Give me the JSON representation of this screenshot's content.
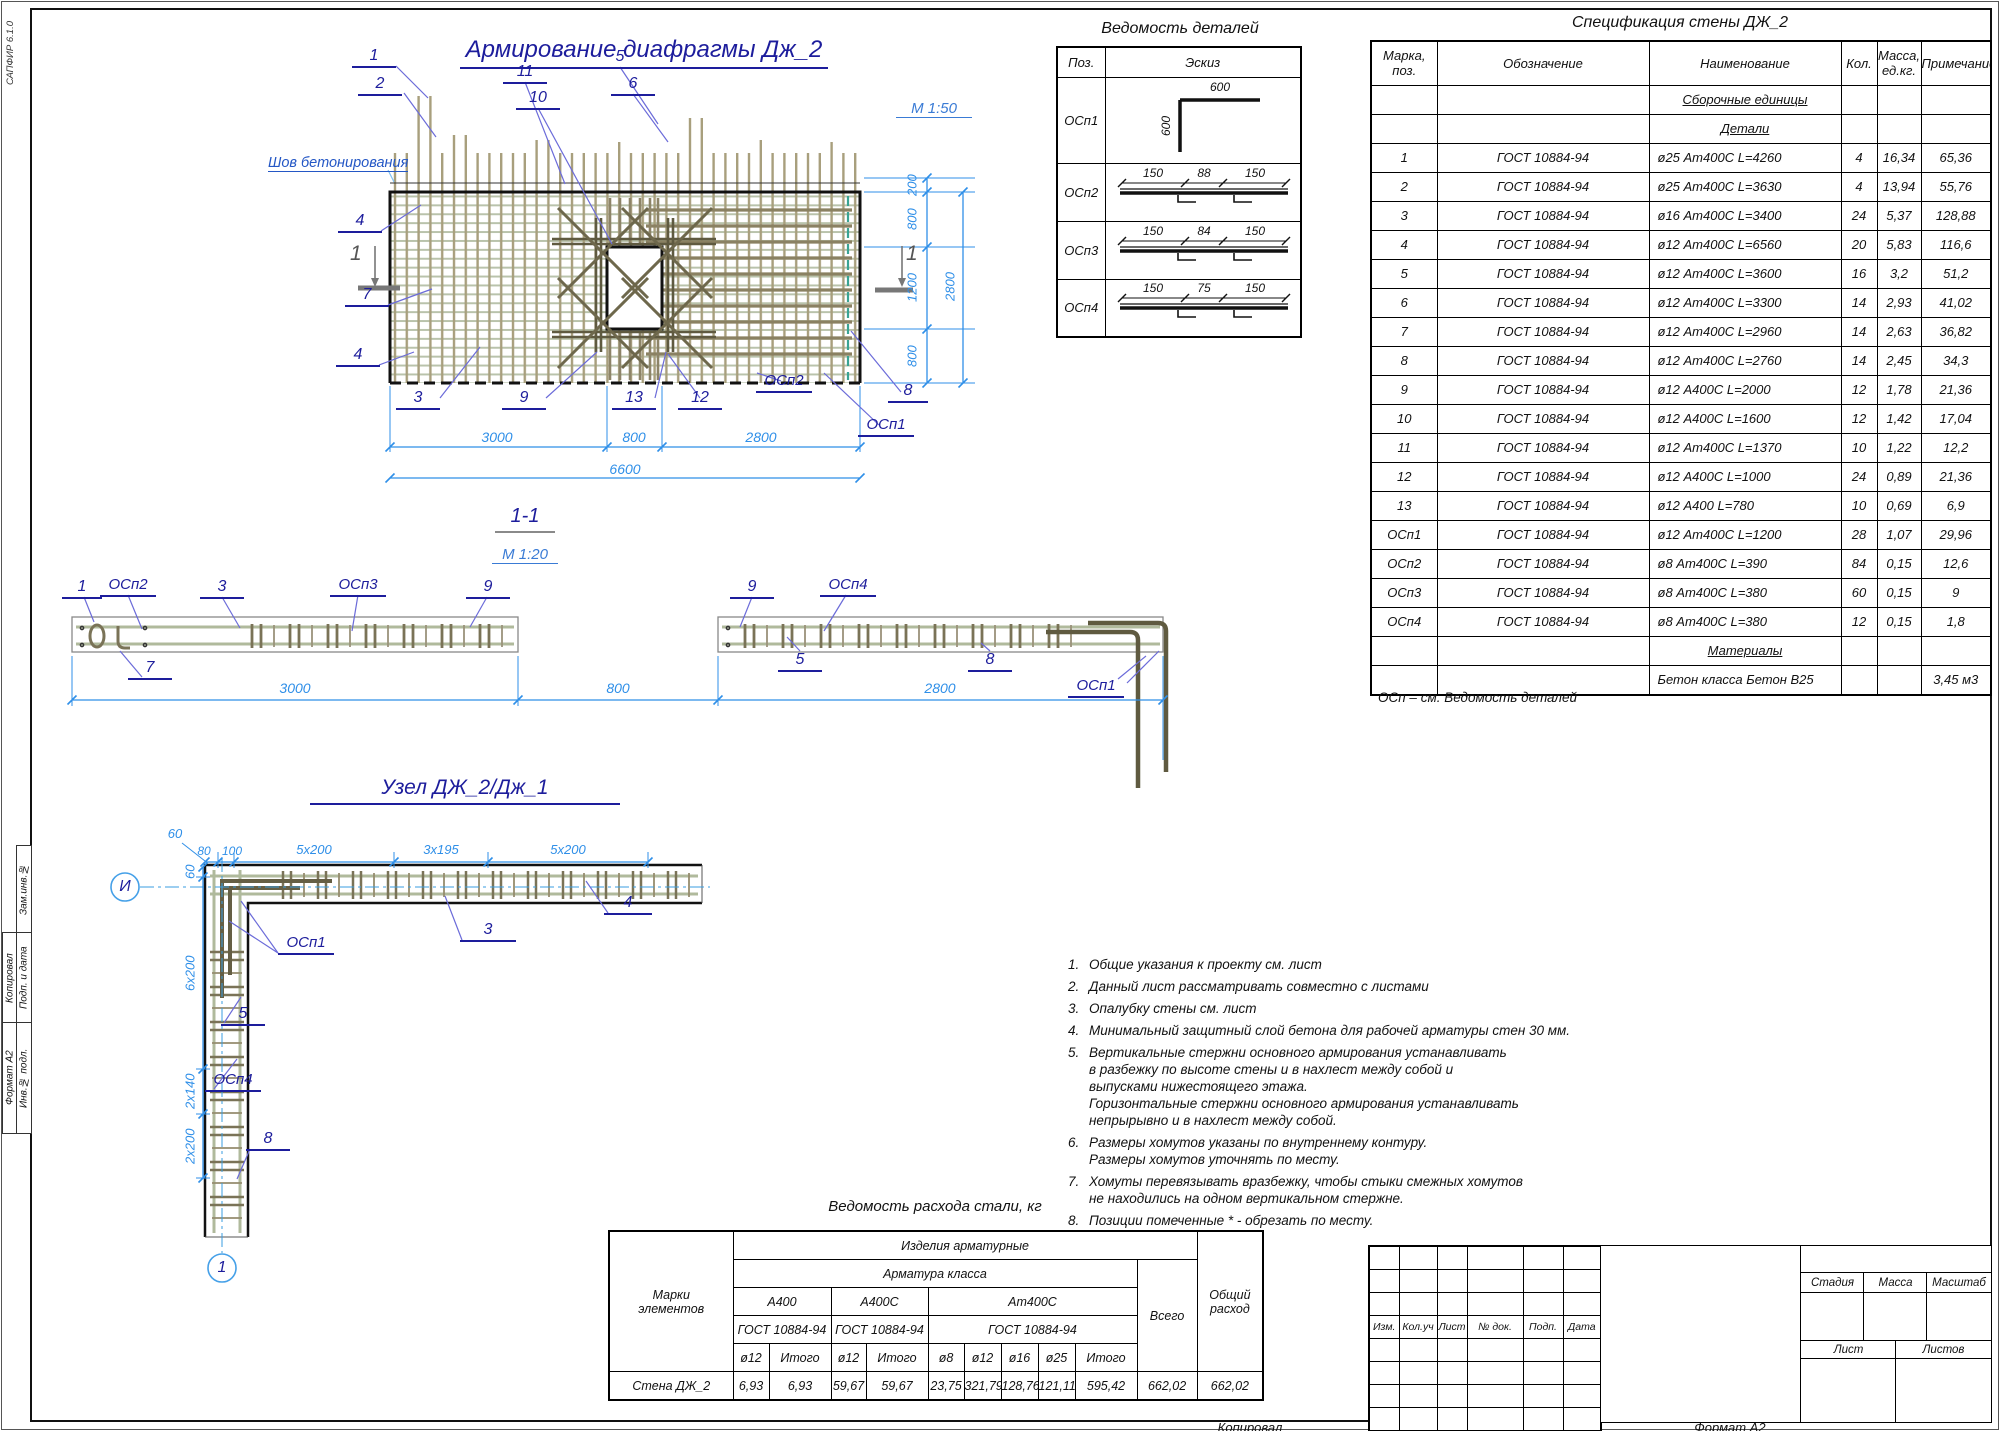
{
  "sheet": {
    "sapfir": "САПФИР 6.1.0",
    "margin_outer": [
      "Копировал",
      "Формат А2"
    ],
    "margin_inner": [
      "Зам.инв.№",
      "Подп. и дата",
      "Инв.№ подл."
    ],
    "footer": {
      "kopiroval": "Копировал",
      "format": "Формат А2"
    }
  },
  "main": {
    "title": "Армирование диафрагмы Дж_2",
    "scale": "М 1:50",
    "seam": "Шов бетонирования",
    "section_digit": "1",
    "callouts": [
      "1",
      "2",
      "11",
      "10",
      "5",
      "6",
      "4",
      "7",
      "4",
      "3",
      "9",
      "13",
      "12",
      "ОСп2",
      "8",
      "ОСп1"
    ],
    "dims_bottom": [
      "3000",
      "800",
      "2800",
      "6600"
    ],
    "dims_right": [
      "200",
      "800",
      "1200",
      "800",
      "2800"
    ]
  },
  "section": {
    "title": "1-1",
    "scale": "М 1:20",
    "callouts": [
      "1",
      "ОСп2",
      "3",
      "ОСп3",
      "9",
      "7",
      "9",
      "ОСп4",
      "5",
      "8",
      "ОСп1"
    ],
    "dims": [
      "3000",
      "800",
      "2800"
    ]
  },
  "node": {
    "title": "Узел  ДЖ_2/Дж_1",
    "axis": "И",
    "bubble": "1",
    "callouts": [
      "ОСп1",
      "3",
      "4",
      "5",
      "ОСп4",
      "8"
    ],
    "dims_top": [
      "60",
      "80",
      "100",
      "5x200",
      "3x195",
      "5x200"
    ],
    "dims_left": [
      "60",
      "6x200",
      "2x140",
      "2x200"
    ]
  },
  "details": {
    "title": "Ведомость деталей",
    "h_poz": "Поз.",
    "h_eskiz": "Эскиз",
    "rows": [
      "ОСп1",
      "ОСп2",
      "ОСп3",
      "ОСп4"
    ],
    "s1": [
      "600",
      "600"
    ],
    "s2": [
      "150",
      "88",
      "150"
    ],
    "s3": [
      "150",
      "84",
      "150"
    ],
    "s4": [
      "150",
      "75",
      "150"
    ]
  },
  "spec": {
    "title": "Спецификация стены ДЖ_2",
    "h_marka": [
      "Марка,",
      "поз."
    ],
    "h_oboz": "Обозначение",
    "h_name": "Наименование",
    "h_qty": "Кол.",
    "h_mass": [
      "Масса,",
      "ед.кг."
    ],
    "h_note": "Примечание",
    "group_sborka": "Сборочные единицы",
    "group_detali": "Детали",
    "group_materialy": "Материалы",
    "rows": [
      [
        "1",
        "ГОСТ 10884-94",
        "ø25 Ат400С L=4260",
        "4",
        "16,34",
        "65,36"
      ],
      [
        "2",
        "ГОСТ 10884-94",
        "ø25 Ат400С L=3630",
        "4",
        "13,94",
        "55,76"
      ],
      [
        "3",
        "ГОСТ 10884-94",
        "ø16 Ат400С L=3400",
        "24",
        "5,37",
        "128,88"
      ],
      [
        "4",
        "ГОСТ 10884-94",
        "ø12 Ат400С L=6560",
        "20",
        "5,83",
        "116,6"
      ],
      [
        "5",
        "ГОСТ 10884-94",
        "ø12 Ат400С L=3600",
        "16",
        "3,2",
        "51,2"
      ],
      [
        "6",
        "ГОСТ 10884-94",
        "ø12 Ат400С L=3300",
        "14",
        "2,93",
        "41,02"
      ],
      [
        "7",
        "ГОСТ 10884-94",
        "ø12 Ат400С L=2960",
        "14",
        "2,63",
        "36,82"
      ],
      [
        "8",
        "ГОСТ 10884-94",
        "ø12 Ат400С L=2760",
        "14",
        "2,45",
        "34,3"
      ],
      [
        "9",
        "ГОСТ 10884-94",
        "ø12 А400С L=2000",
        "12",
        "1,78",
        "21,36"
      ],
      [
        "10",
        "ГОСТ 10884-94",
        "ø12 А400С L=1600",
        "12",
        "1,42",
        "17,04"
      ],
      [
        "11",
        "ГОСТ 10884-94",
        "ø12 Ат400С L=1370",
        "10",
        "1,22",
        "12,2"
      ],
      [
        "12",
        "ГОСТ 10884-94",
        "ø12 А400С L=1000",
        "24",
        "0,89",
        "21,36"
      ],
      [
        "13",
        "ГОСТ 10884-94",
        "ø12 А400 L=780",
        "10",
        "0,69",
        "6,9"
      ],
      [
        "ОСп1",
        "ГОСТ 10884-94",
        "ø12 Ат400С L=1200",
        "28",
        "1,07",
        "29,96"
      ],
      [
        "ОСп2",
        "ГОСТ 10884-94",
        "ø8 Ат400С L=390",
        "84",
        "0,15",
        "12,6"
      ],
      [
        "ОСп3",
        "ГОСТ 10884-94",
        "ø8 Ат400С L=380",
        "60",
        "0,15",
        "9"
      ],
      [
        "ОСп4",
        "ГОСТ 10884-94",
        "ø8 Ат400С L=380",
        "12",
        "0,15",
        "1,8"
      ]
    ],
    "concrete": {
      "name": "Бетон класса Бетон В25",
      "note": "3,45 м3"
    },
    "footnote": "ОСп – см. Ведомость деталей"
  },
  "steel": {
    "title": "Ведомость расхода стали, кг",
    "h_marki": [
      "Марки",
      "элементов"
    ],
    "h_izdeliya": "Изделия арматурные",
    "h_armatura": "Арматура класса",
    "classes": [
      {
        "name": "А400",
        "gost": "ГОСТ 10884-94",
        "cols": [
          "ø12",
          "Итого"
        ]
      },
      {
        "name": "А400С",
        "gost": "ГОСТ 10884-94",
        "cols": [
          "ø12",
          "Итого"
        ]
      },
      {
        "name": "Ат400С",
        "gost": "ГОСТ 10884-94",
        "cols": [
          "ø8",
          "ø12",
          "ø16",
          "ø25",
          "Итого"
        ]
      }
    ],
    "h_vsego": "Всего",
    "h_obshchiy": [
      "Общий",
      "расход"
    ],
    "row_name": "Стена ДЖ_2",
    "values": [
      "6,93",
      "6,93",
      "59,67",
      "59,67",
      "23,75",
      "321,79",
      "128,76",
      "121,11",
      "595,42",
      "662,02",
      "662,02"
    ]
  },
  "notes": {
    "items": [
      {
        "n": "1.",
        "lines": [
          "Общие указания к проекту см. лист"
        ]
      },
      {
        "n": "2.",
        "lines": [
          "Данный лист рассматривать совместно с листами"
        ]
      },
      {
        "n": "3.",
        "lines": [
          "Опалубку стены см. лист"
        ]
      },
      {
        "n": "4.",
        "lines": [
          "Минимальный защитный слой бетона для рабочей арматуры стен 30 мм."
        ]
      },
      {
        "n": "5.",
        "lines": [
          "Вертикальные стержни основного армирования устанавливать",
          "в разбежку по высоте стены и в нахлест между собой и",
          "выпусками нижестоящего этажа.",
          "Горизонтальные стержни основного армирования устанавливать",
          "непрырывно и в нахлест между собой."
        ]
      },
      {
        "n": "6.",
        "lines": [
          "Размеры хомутов указаны по внутреннему контуру.",
          "Размеры хомутов уточнять по месту."
        ]
      },
      {
        "n": "7.",
        "lines": [
          "Хомуты перевязывать вразбежку, чтобы стыки смежных хомутов",
          "не находились на одном вертикальном стержне."
        ]
      },
      {
        "n": "8.",
        "lines": [
          "Позиции помеченные * - обрезать по месту."
        ]
      }
    ]
  },
  "stamp": {
    "izm": [
      "Изм.",
      "Кол.уч",
      "Лист",
      "№ док.",
      "Подп.",
      "Дата"
    ],
    "stadiya": "Стадия",
    "massa": "Масса",
    "masshtab": "Масштаб",
    "list": "Лист",
    "listov": "Листов"
  }
}
